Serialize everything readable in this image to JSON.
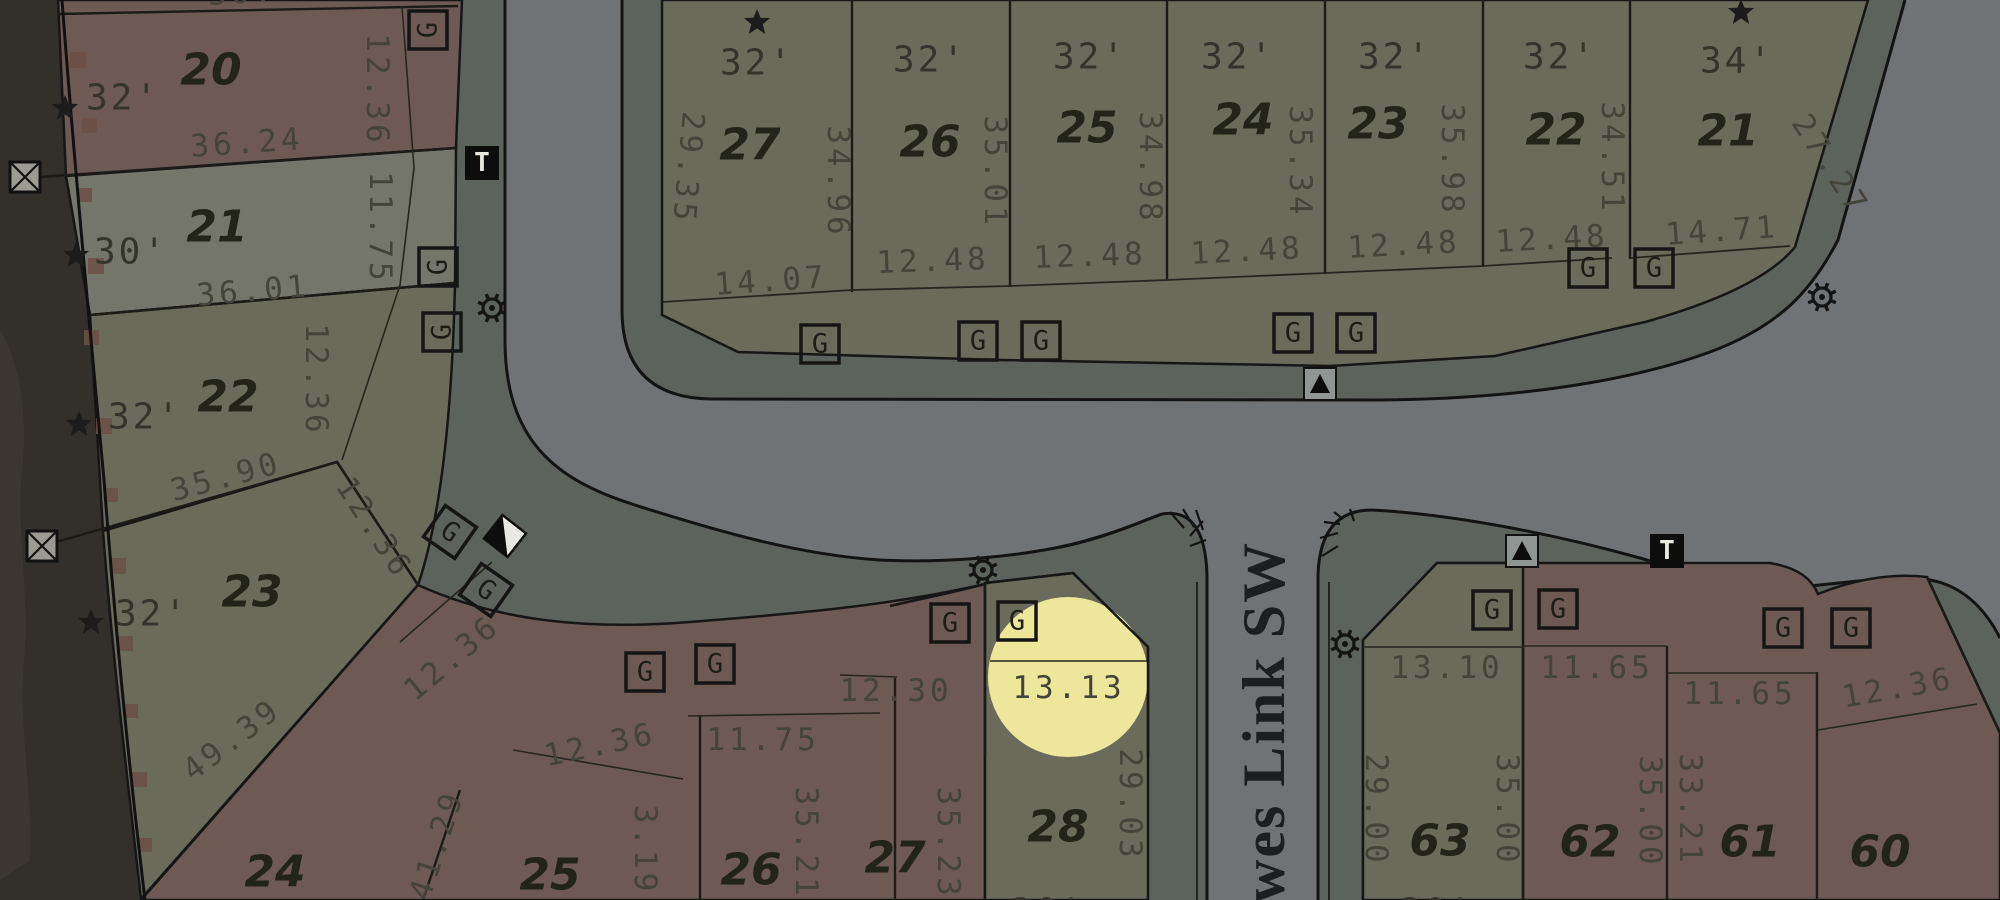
{
  "map": {
    "street": {
      "name_visible": "owes Link SW"
    },
    "highlight": {
      "cx": 1068,
      "cy": 677,
      "r": 80,
      "color": "#f7f1a0",
      "opacity": 0.93,
      "highlighted_value": "13.13"
    },
    "colors": {
      "road": "#707375",
      "sidewalk": "#5c625c",
      "lot_olive": "#6a6b5b",
      "lot_red": "#6d5a55",
      "lot_light": "#74766c",
      "outside_dark": "#332f2b",
      "boundary_blotch": "#6b5046",
      "line": "#161616",
      "highlight_yellow": "#f7f1a0"
    },
    "labels": [
      {
        "text": "36.0",
        "x": 253,
        "y": -8,
        "rot": -4,
        "cls": "dim",
        "partial": true
      },
      {
        "text": "20",
        "x": 211,
        "y": 70,
        "rot": 0,
        "cls": "lot"
      },
      {
        "text": "32'",
        "x": 123,
        "y": 98,
        "rot": 0,
        "cls": "feet"
      },
      {
        "text": "36.24",
        "x": 247,
        "y": 143,
        "rot": -4,
        "cls": "dim"
      },
      {
        "text": "12.36",
        "x": 377,
        "y": 90,
        "rot": 90,
        "cls": "dim"
      },
      {
        "text": "21",
        "x": 217,
        "y": 227,
        "rot": 0,
        "cls": "lot"
      },
      {
        "text": "30'",
        "x": 131,
        "y": 252,
        "rot": 0,
        "cls": "feet"
      },
      {
        "text": "36.01",
        "x": 253,
        "y": 291,
        "rot": -5,
        "cls": "dim"
      },
      {
        "text": "11.75",
        "x": 380,
        "y": 228,
        "rot": 90,
        "cls": "dim"
      },
      {
        "text": "22",
        "x": 228,
        "y": 397,
        "rot": 0,
        "cls": "lot"
      },
      {
        "text": "32'",
        "x": 145,
        "y": 417,
        "rot": 0,
        "cls": "feet"
      },
      {
        "text": "35.90",
        "x": 226,
        "y": 477,
        "rot": -15,
        "cls": "dim"
      },
      {
        "text": "12.36",
        "x": 316,
        "y": 380,
        "rot": 90,
        "cls": "dim"
      },
      {
        "text": "12.36",
        "x": 374,
        "y": 528,
        "rot": 57,
        "cls": "dim"
      },
      {
        "text": "23",
        "x": 252,
        "y": 592,
        "rot": 0,
        "cls": "lot"
      },
      {
        "text": "32'",
        "x": 152,
        "y": 614,
        "rot": 0,
        "cls": "feet"
      },
      {
        "text": "49.39",
        "x": 232,
        "y": 740,
        "rot": -37,
        "cls": "dim"
      },
      {
        "text": "27",
        "x": 750,
        "y": 145,
        "rot": 0,
        "cls": "lot"
      },
      {
        "text": "32'",
        "x": 757,
        "y": 63,
        "rot": 0,
        "cls": "feet"
      },
      {
        "text": "26",
        "x": 930,
        "y": 142,
        "rot": 0,
        "cls": "lot"
      },
      {
        "text": "32'",
        "x": 930,
        "y": 60,
        "rot": 0,
        "cls": "feet"
      },
      {
        "text": "25",
        "x": 1087,
        "y": 128,
        "rot": 0,
        "cls": "lot"
      },
      {
        "text": "32'",
        "x": 1090,
        "y": 57,
        "rot": 0,
        "cls": "feet"
      },
      {
        "text": "24",
        "x": 1243,
        "y": 120,
        "rot": 0,
        "cls": "lot"
      },
      {
        "text": "32'",
        "x": 1238,
        "y": 57,
        "rot": 0,
        "cls": "feet"
      },
      {
        "text": "23",
        "x": 1378,
        "y": 124,
        "rot": 0,
        "cls": "lot"
      },
      {
        "text": "32'",
        "x": 1395,
        "y": 57,
        "rot": 0,
        "cls": "feet"
      },
      {
        "text": "22",
        "x": 1556,
        "y": 130,
        "rot": 0,
        "cls": "lot"
      },
      {
        "text": "32'",
        "x": 1560,
        "y": 57,
        "rot": 0,
        "cls": "feet"
      },
      {
        "text": "21",
        "x": 1728,
        "y": 131,
        "rot": 0,
        "cls": "lot"
      },
      {
        "text": "34'",
        "x": 1737,
        "y": 61,
        "rot": 0,
        "cls": "feet"
      },
      {
        "text": "29.35",
        "x": 688,
        "y": 168,
        "rot": 95,
        "cls": "dim"
      },
      {
        "text": "34.96",
        "x": 838,
        "y": 182,
        "rot": 90,
        "cls": "dim"
      },
      {
        "text": "35.01",
        "x": 995,
        "y": 172,
        "rot": 90,
        "cls": "dim"
      },
      {
        "text": "34.98",
        "x": 1150,
        "y": 168,
        "rot": 90,
        "cls": "dim"
      },
      {
        "text": "35.34",
        "x": 1300,
        "y": 162,
        "rot": 90,
        "cls": "dim"
      },
      {
        "text": "35.98",
        "x": 1452,
        "y": 160,
        "rot": 90,
        "cls": "dim"
      },
      {
        "text": "34.51",
        "x": 1612,
        "y": 158,
        "rot": 90,
        "cls": "dim"
      },
      {
        "text": "27.27",
        "x": 1830,
        "y": 165,
        "rot": 57,
        "cls": "dim"
      },
      {
        "text": "14.07",
        "x": 771,
        "y": 281,
        "rot": -4,
        "cls": "dim"
      },
      {
        "text": "12.48",
        "x": 933,
        "y": 261,
        "rot": -2,
        "cls": "dim"
      },
      {
        "text": "12.48",
        "x": 1090,
        "y": 256,
        "rot": -2,
        "cls": "dim"
      },
      {
        "text": "12.48",
        "x": 1247,
        "y": 251,
        "rot": -3,
        "cls": "dim"
      },
      {
        "text": "12.48",
        "x": 1404,
        "y": 245,
        "rot": -3,
        "cls": "dim"
      },
      {
        "text": "12.48",
        "x": 1552,
        "y": 239,
        "rot": -3,
        "cls": "dim"
      },
      {
        "text": "14.71",
        "x": 1722,
        "y": 231,
        "rot": -4,
        "cls": "dim"
      },
      {
        "text": "24",
        "x": 275,
        "y": 872,
        "rot": 0,
        "cls": "lot"
      },
      {
        "text": "41.29",
        "x": 437,
        "y": 845,
        "rot": -72,
        "cls": "dim"
      },
      {
        "text": "25",
        "x": 550,
        "y": 875,
        "rot": 0,
        "cls": "lot"
      },
      {
        "text": "3.19",
        "x": 645,
        "y": 850,
        "rot": 90,
        "cls": "dim"
      },
      {
        "text": "12.36",
        "x": 452,
        "y": 658,
        "rot": -40,
        "cls": "dim"
      },
      {
        "text": "12.36",
        "x": 600,
        "y": 745,
        "rot": -12,
        "cls": "dim"
      },
      {
        "text": "11.75",
        "x": 763,
        "y": 740,
        "rot": 0,
        "cls": "dim"
      },
      {
        "text": "26",
        "x": 751,
        "y": 870,
        "rot": 0,
        "cls": "lot"
      },
      {
        "text": "35.21",
        "x": 806,
        "y": 843,
        "rot": 90,
        "cls": "dim"
      },
      {
        "text": "12.30",
        "x": 896,
        "y": 691,
        "rot": 0,
        "cls": "dim"
      },
      {
        "text": "27",
        "x": 895,
        "y": 858,
        "rot": 0,
        "cls": "lot"
      },
      {
        "text": "35.23",
        "x": 948,
        "y": 843,
        "rot": 90,
        "cls": "dim"
      },
      {
        "text": "13.13",
        "x": 1069,
        "y": 688,
        "rot": 0,
        "cls": "dim"
      },
      {
        "text": "28",
        "x": 1058,
        "y": 827,
        "rot": 0,
        "cls": "lot"
      },
      {
        "text": "29.03",
        "x": 1130,
        "y": 805,
        "rot": 90,
        "cls": "dim"
      },
      {
        "text": "30'",
        "x": 1048,
        "y": 912,
        "rot": 0,
        "cls": "feet",
        "partial": true
      },
      {
        "text": "13.10",
        "x": 1447,
        "y": 668,
        "rot": 0,
        "cls": "dim"
      },
      {
        "text": "11.65",
        "x": 1597,
        "y": 668,
        "rot": 0,
        "cls": "dim"
      },
      {
        "text": "11.65",
        "x": 1740,
        "y": 694,
        "rot": 0,
        "cls": "dim"
      },
      {
        "text": "12.36",
        "x": 1898,
        "y": 688,
        "rot": -10,
        "cls": "dim"
      },
      {
        "text": "29.00",
        "x": 1376,
        "y": 810,
        "rot": 90,
        "cls": "dim"
      },
      {
        "text": "63",
        "x": 1440,
        "y": 841,
        "rot": 0,
        "cls": "lot"
      },
      {
        "text": "35.00",
        "x": 1507,
        "y": 810,
        "rot": 90,
        "cls": "dim"
      },
      {
        "text": "62",
        "x": 1590,
        "y": 842,
        "rot": 0,
        "cls": "lot"
      },
      {
        "text": "35.00",
        "x": 1650,
        "y": 812,
        "rot": 90,
        "cls": "dim"
      },
      {
        "text": "33.21",
        "x": 1690,
        "y": 810,
        "rot": 90,
        "cls": "dim"
      },
      {
        "text": "61",
        "x": 1750,
        "y": 842,
        "rot": 0,
        "cls": "lot"
      },
      {
        "text": "60",
        "x": 1880,
        "y": 852,
        "rot": 0,
        "cls": "lot"
      },
      {
        "text": "30'",
        "x": 1437,
        "y": 912,
        "rot": 0,
        "cls": "feet",
        "partial": true
      }
    ],
    "stars": [
      {
        "x": 65,
        "y": 108
      },
      {
        "x": 76,
        "y": 255
      },
      {
        "x": 79,
        "y": 424
      },
      {
        "x": 91,
        "y": 622
      },
      {
        "x": 757,
        "y": 22
      },
      {
        "x": 1741,
        "y": 12
      }
    ],
    "markers": {
      "g_letter": "G",
      "t_letter": "T",
      "g_boxes": [
        {
          "x": 428,
          "y": 30,
          "rot": 0,
          "lr": -90
        },
        {
          "x": 438,
          "y": 267,
          "rot": 0,
          "lr": -90
        },
        {
          "x": 442,
          "y": 332,
          "rot": 0,
          "lr": -90
        },
        {
          "x": 820,
          "y": 344,
          "rot": 0
        },
        {
          "x": 978,
          "y": 341,
          "rot": 0
        },
        {
          "x": 1041,
          "y": 341,
          "rot": 0
        },
        {
          "x": 1293,
          "y": 333,
          "rot": 0
        },
        {
          "x": 1356,
          "y": 333,
          "rot": 0
        },
        {
          "x": 1588,
          "y": 268,
          "rot": 0
        },
        {
          "x": 1654,
          "y": 268,
          "rot": 0
        },
        {
          "x": 450,
          "y": 532,
          "rot": 35
        },
        {
          "x": 486,
          "y": 590,
          "rot": 35
        },
        {
          "x": 645,
          "y": 672,
          "rot": 0
        },
        {
          "x": 715,
          "y": 664,
          "rot": 0
        },
        {
          "x": 950,
          "y": 623,
          "rot": 0
        },
        {
          "x": 1017,
          "y": 621,
          "rot": 0
        },
        {
          "x": 1492,
          "y": 610,
          "rot": 0
        },
        {
          "x": 1558,
          "y": 609,
          "rot": 0
        },
        {
          "x": 1783,
          "y": 628,
          "rot": 0
        },
        {
          "x": 1851,
          "y": 628,
          "rot": 0
        }
      ],
      "t_boxes": [
        {
          "x": 482,
          "y": 163
        },
        {
          "x": 1667,
          "y": 551
        }
      ],
      "tri_boxes": [
        {
          "x": 1320,
          "y": 384
        },
        {
          "x": 1522,
          "y": 551
        }
      ],
      "split_diamonds": [
        {
          "x": 505,
          "y": 536,
          "rot": 38
        }
      ],
      "suns": [
        {
          "x": 492,
          "y": 308
        },
        {
          "x": 983,
          "y": 570
        },
        {
          "x": 1345,
          "y": 644
        },
        {
          "x": 1822,
          "y": 297
        }
      ],
      "x_boxes": [
        {
          "x": 25,
          "y": 177
        },
        {
          "x": 42,
          "y": 546
        }
      ]
    }
  }
}
